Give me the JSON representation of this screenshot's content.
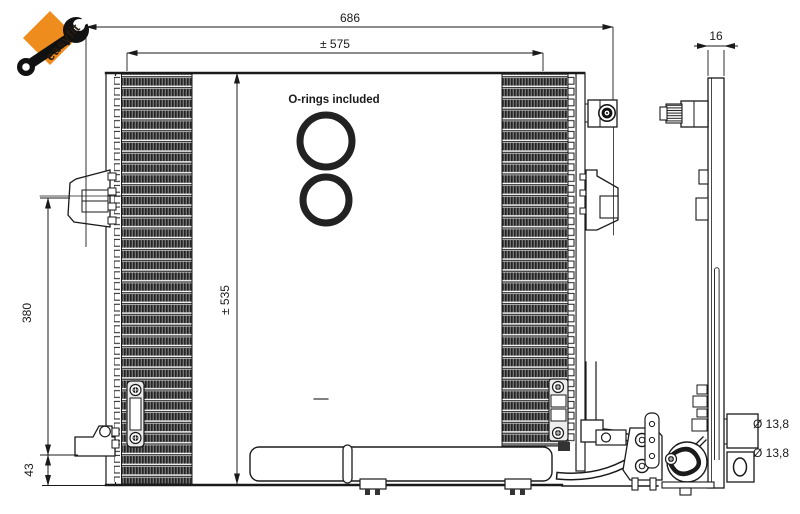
{
  "page": {
    "background_color": "#ffffff",
    "line_color": "#1a1a1a"
  },
  "logo": {
    "brand": "easyfit",
    "bg_color": "#EE8C1E",
    "icon": "wrench-icon"
  },
  "annotations": {
    "orings_note": "O-rings included"
  },
  "dimensions": {
    "overall_width": "686",
    "core_width": "± 575",
    "core_height": "± 535",
    "mount_height": "380",
    "bottom_offset": "43",
    "depth": "16",
    "port_diameter_top": "Ø 13,8",
    "port_diameter_bottom": "Ø 13,8"
  }
}
